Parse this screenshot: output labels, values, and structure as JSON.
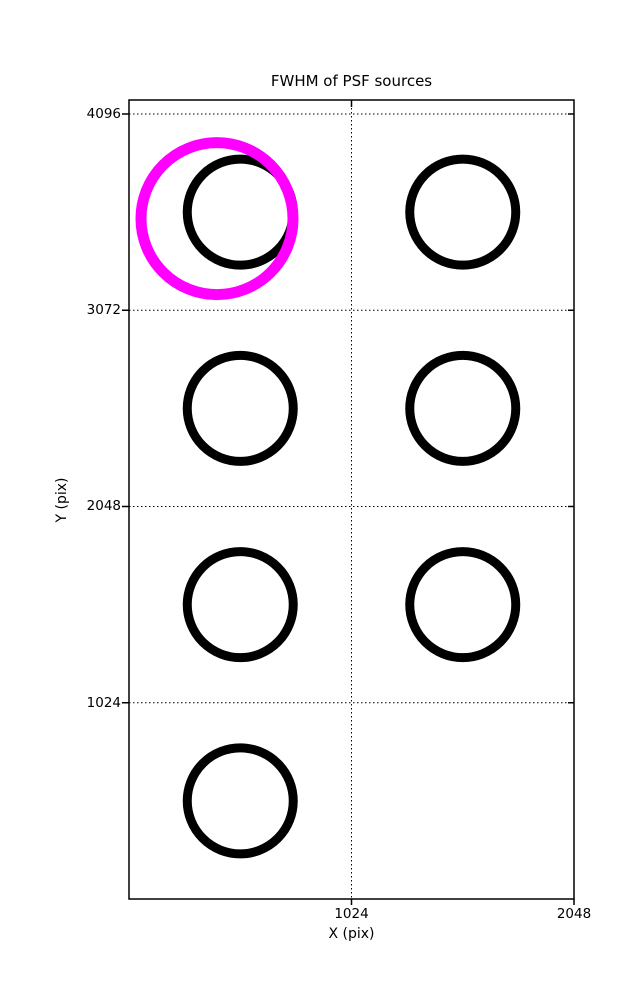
{
  "chart_data": {
    "type": "scatter",
    "title": "FWHM of PSF sources",
    "xlabel": "X (pix)",
    "ylabel": "Y (pix)",
    "xlim": [
      0,
      2048
    ],
    "ylim": [
      0,
      4169
    ],
    "xticks": [
      1024,
      2048
    ],
    "yticks": [
      1024,
      2048,
      3072,
      4096
    ],
    "grid_x": [
      1024
    ],
    "grid_y": [
      1024,
      2048,
      3072,
      4096
    ],
    "grid_style": "dotted",
    "legend": "none",
    "background_color": "#ffffff",
    "axis_color": "#000000",
    "sources": [
      {
        "x": 512,
        "y": 3584,
        "marker_radius_px": 53,
        "stroke_px": 9,
        "color": "#000000"
      },
      {
        "x": 1536,
        "y": 3584,
        "marker_radius_px": 53,
        "stroke_px": 9,
        "color": "#000000"
      },
      {
        "x": 512,
        "y": 2560,
        "marker_radius_px": 53,
        "stroke_px": 9,
        "color": "#000000"
      },
      {
        "x": 1536,
        "y": 2560,
        "marker_radius_px": 53,
        "stroke_px": 9,
        "color": "#000000"
      },
      {
        "x": 512,
        "y": 1536,
        "marker_radius_px": 53,
        "stroke_px": 9,
        "color": "#000000"
      },
      {
        "x": 1536,
        "y": 1536,
        "marker_radius_px": 53,
        "stroke_px": 9,
        "color": "#000000"
      },
      {
        "x": 512,
        "y": 512,
        "marker_radius_px": 53,
        "stroke_px": 9,
        "color": "#000000"
      }
    ],
    "highlight": {
      "x": 405,
      "y": 3550,
      "marker_radius_px": 76,
      "stroke_px": 11,
      "color": "#ff00ff"
    }
  }
}
